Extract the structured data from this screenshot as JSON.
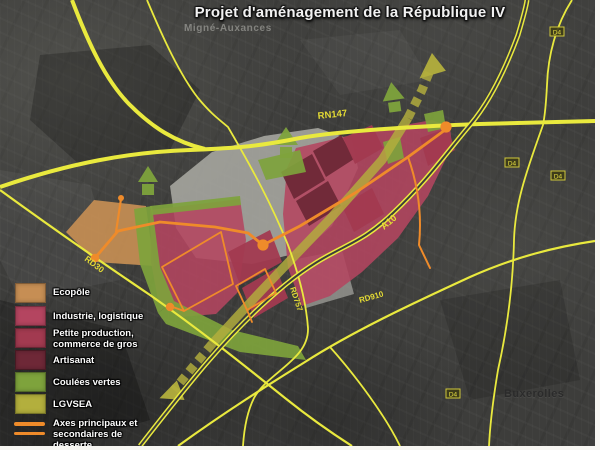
{
  "title": "Projet d'aménagement de la République IV",
  "map": {
    "place_labels": {
      "migne": "Migné-Auxances",
      "buxerolles": "Buxerolles"
    },
    "roads": {
      "rn147": "RN147",
      "a10": "A10",
      "rd30": "RD30",
      "rd757": "RD757",
      "rd910": "RD910",
      "shields": [
        {
          "label": "D4"
        },
        {
          "label": "D4"
        },
        {
          "label": "D4"
        },
        {
          "label": "D4"
        }
      ]
    }
  },
  "legend": {
    "items": [
      {
        "label": "Ecopôle",
        "color": "#c68e54"
      },
      {
        "label": "Industrie, logistique",
        "color": "#b44560"
      },
      {
        "line1": "Petite production,",
        "line2": "commerce de gros",
        "color": "#a23a50"
      },
      {
        "label": "Artisanat",
        "color": "#6e2837"
      },
      {
        "label": "Coulées vertes",
        "color": "#7ea33c"
      },
      {
        "label": "LGVSEA",
        "color": "#b3af3d"
      },
      {
        "line1": "Axes principaux et",
        "line2": "secondaires de",
        "line3": "desserte",
        "color": "#ef8b2a"
      }
    ]
  },
  "colors": {
    "road_yellow": "#e9e93e",
    "axis_orange": "#ef8b2a",
    "lgv_band": "#b3af3d",
    "green": "#7ea33c",
    "gray_zone": "#a8a8a2",
    "background": "#3d3d3b"
  }
}
